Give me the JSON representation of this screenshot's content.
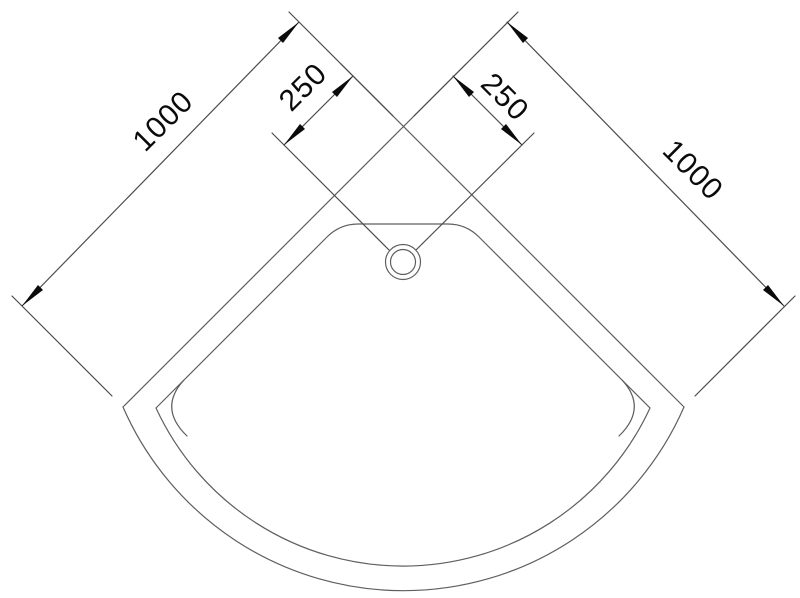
{
  "drawing": {
    "labels": {
      "left_length": "1000",
      "left_offset": "250",
      "right_offset": "250",
      "right_length": "1000"
    },
    "colors": {
      "outline": "#5f5f5f",
      "dimension": "#4c4c4c",
      "arrow": "#0b0b0b",
      "text": "#0b0b0b",
      "background": "#ffffff"
    }
  }
}
